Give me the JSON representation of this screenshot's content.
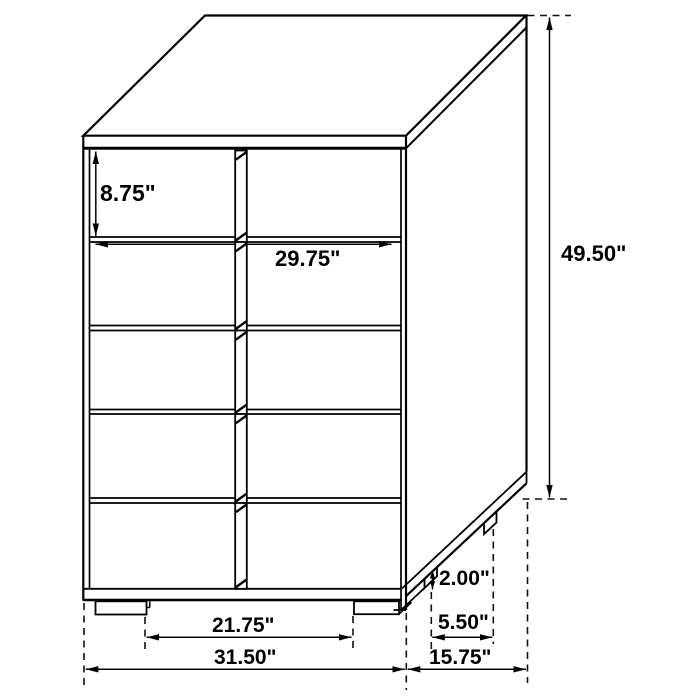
{
  "diagram": {
    "subject": "five-drawer-chest-dimension-drawing",
    "unit": "inches",
    "drawer_rows": 5,
    "drawer_columns": 2,
    "colors": {
      "line": "#000000",
      "background": "#ffffff",
      "text": "#000000"
    },
    "dimensions": {
      "top_drawer_height": {
        "label": "8.75\"",
        "value": 8.75
      },
      "drawer_width": {
        "label": "29.75\"",
        "value": 29.75
      },
      "overall_height": {
        "label": "49.50\"",
        "value": 49.5
      },
      "leg_height": {
        "label": "2.00\"",
        "value": 2.0
      },
      "side_leg_spacing": {
        "label": "5.50\"",
        "value": 5.5
      },
      "front_leg_spacing": {
        "label": "21.75\"",
        "value": 21.75
      },
      "overall_width": {
        "label": "31.50\"",
        "value": 31.5
      },
      "overall_depth": {
        "label": "15.75\"",
        "value": 15.75
      }
    }
  }
}
